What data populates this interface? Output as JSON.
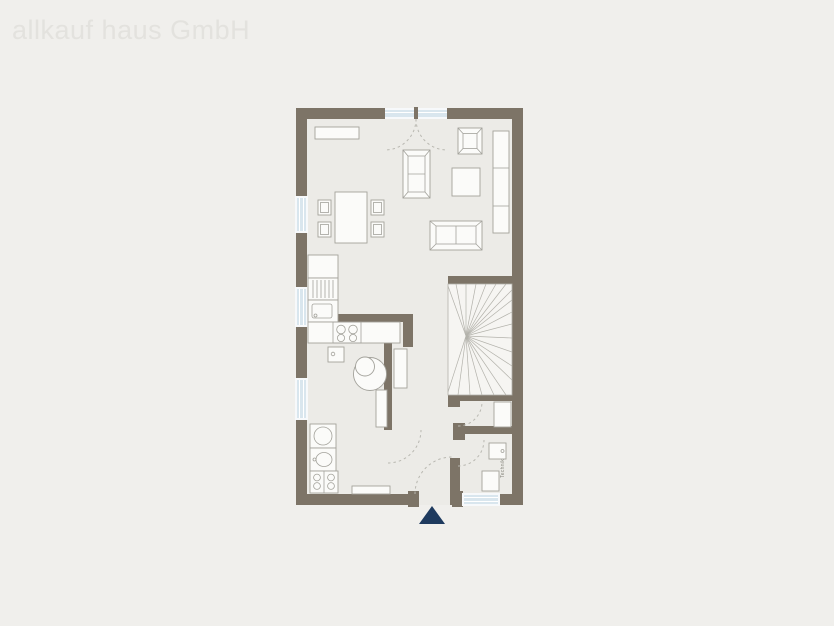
{
  "brand": {
    "watermark": "allkauf haus GmbH"
  },
  "plan": {
    "type": "floor-plan",
    "technik_label": "Technik",
    "rooms": [
      "living-dining-room",
      "open-kitchen",
      "bathroom-utility-room",
      "hallway",
      "staircase",
      "understair-storage",
      "technik-room"
    ]
  },
  "colors": {
    "bg": "#f0efec",
    "watermark": "#e3e2de",
    "wall": "#7d7467",
    "floor": "#ecebe7",
    "furn-fill": "#fbfbf9",
    "furn-line": "#a3a29b",
    "stair-line": "#b3b2ab",
    "glass": "#d9e6ee",
    "window-frame": "#f7f9fb",
    "arc": "#b9b8b1",
    "accent": "#1e3a5e",
    "label": "#8b8a80"
  }
}
